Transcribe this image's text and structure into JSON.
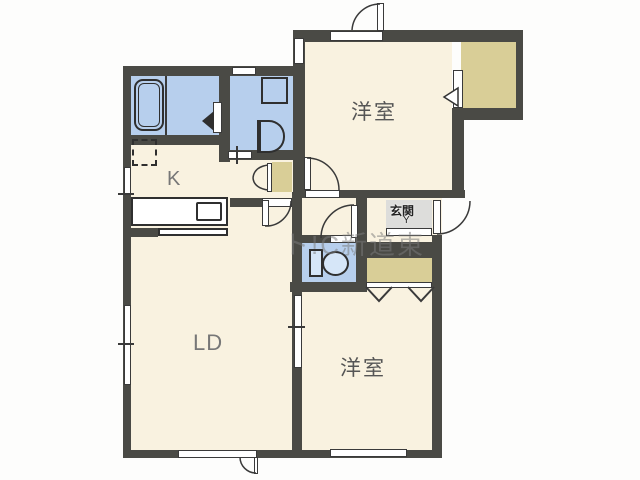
{
  "labels": {
    "kitchen": "K",
    "living_dining": "LD",
    "western_room_top": "洋室",
    "western_room_bottom": "洋室",
    "entrance": "玄関",
    "entrance_step_mark": "Y"
  },
  "watermark": "ト!C新道東",
  "colors": {
    "wall": "#4a4a45",
    "room_floor": "#f9f2e0",
    "wet_area": "#b7cfed",
    "closet": "#d9ce97",
    "entrance_tile": "#dddddb",
    "fixture_outline": "#2f2f2f"
  },
  "fixture_icons": [
    "bathtub-icon",
    "washing-machine-icon",
    "washbasin-icon",
    "toilet-icon",
    "kitchen-counter-icon",
    "sink-icon",
    "refrigerator-space-icon"
  ]
}
